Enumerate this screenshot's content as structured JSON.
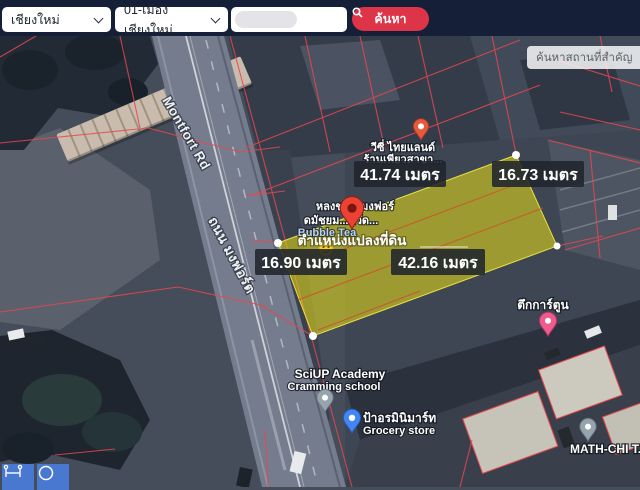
{
  "topbar": {
    "province": "เชียงใหม่",
    "district": "01-เมืองเชียงใหม่",
    "keyword_value": "",
    "search_label": "ค้นหา"
  },
  "map_search": {
    "placeholder": "ค้นหาสถานที่สำคัญ"
  },
  "measurements": {
    "top": "41.74 เมตร",
    "right": "16.73 เมตร",
    "left": "16.90 เมตร",
    "bottom": "42.16 เมตร"
  },
  "parcel": {
    "location_label": "ตำแหน่งแปลงที่ดิน"
  },
  "roads": {
    "montfort_en": "Montfort Rd",
    "montfort_th": "ถนน มงฟอร์ต"
  },
  "pois": {
    "vichy": {
      "line1": "วีซี่ ไทยแลนด์",
      "line2": "ร้านเพียวสาขา..."
    },
    "near_pin": {
      "line1": "หลงชา... มงฟอร์",
      "line2": "ดมัชยม...หวัด...",
      "line3": "Bubble Tea"
    },
    "sciup": {
      "line1": "SciUP Academy",
      "line2": "Cramming school"
    },
    "grocery": {
      "line1": "ป้าอรมินิมาร์ท",
      "line2": "Grocery store"
    },
    "cartoon": {
      "line1": "ตึกการ์ตูน"
    },
    "math": {
      "line1": "MATH-CHI T..."
    }
  },
  "icons": {
    "search": "magnifier",
    "select_arrow": "chevron-down",
    "tool1": "measure-distance",
    "tool2": "draw-circle",
    "marker": "map-pin"
  },
  "colors": {
    "topbar_bg": "#152038",
    "search_button_bg": "#dd3448",
    "parcel_highlight": "#d6cf1c",
    "cadastral_line": "#e8474d",
    "tool_button_bg": "#4878cf",
    "pin_red": "#ea4335",
    "pin_blue": "#4285f4",
    "pin_pink": "#ee5c8e",
    "pin_gray": "#96a4ae",
    "pin_orange": "#e8593c"
  }
}
